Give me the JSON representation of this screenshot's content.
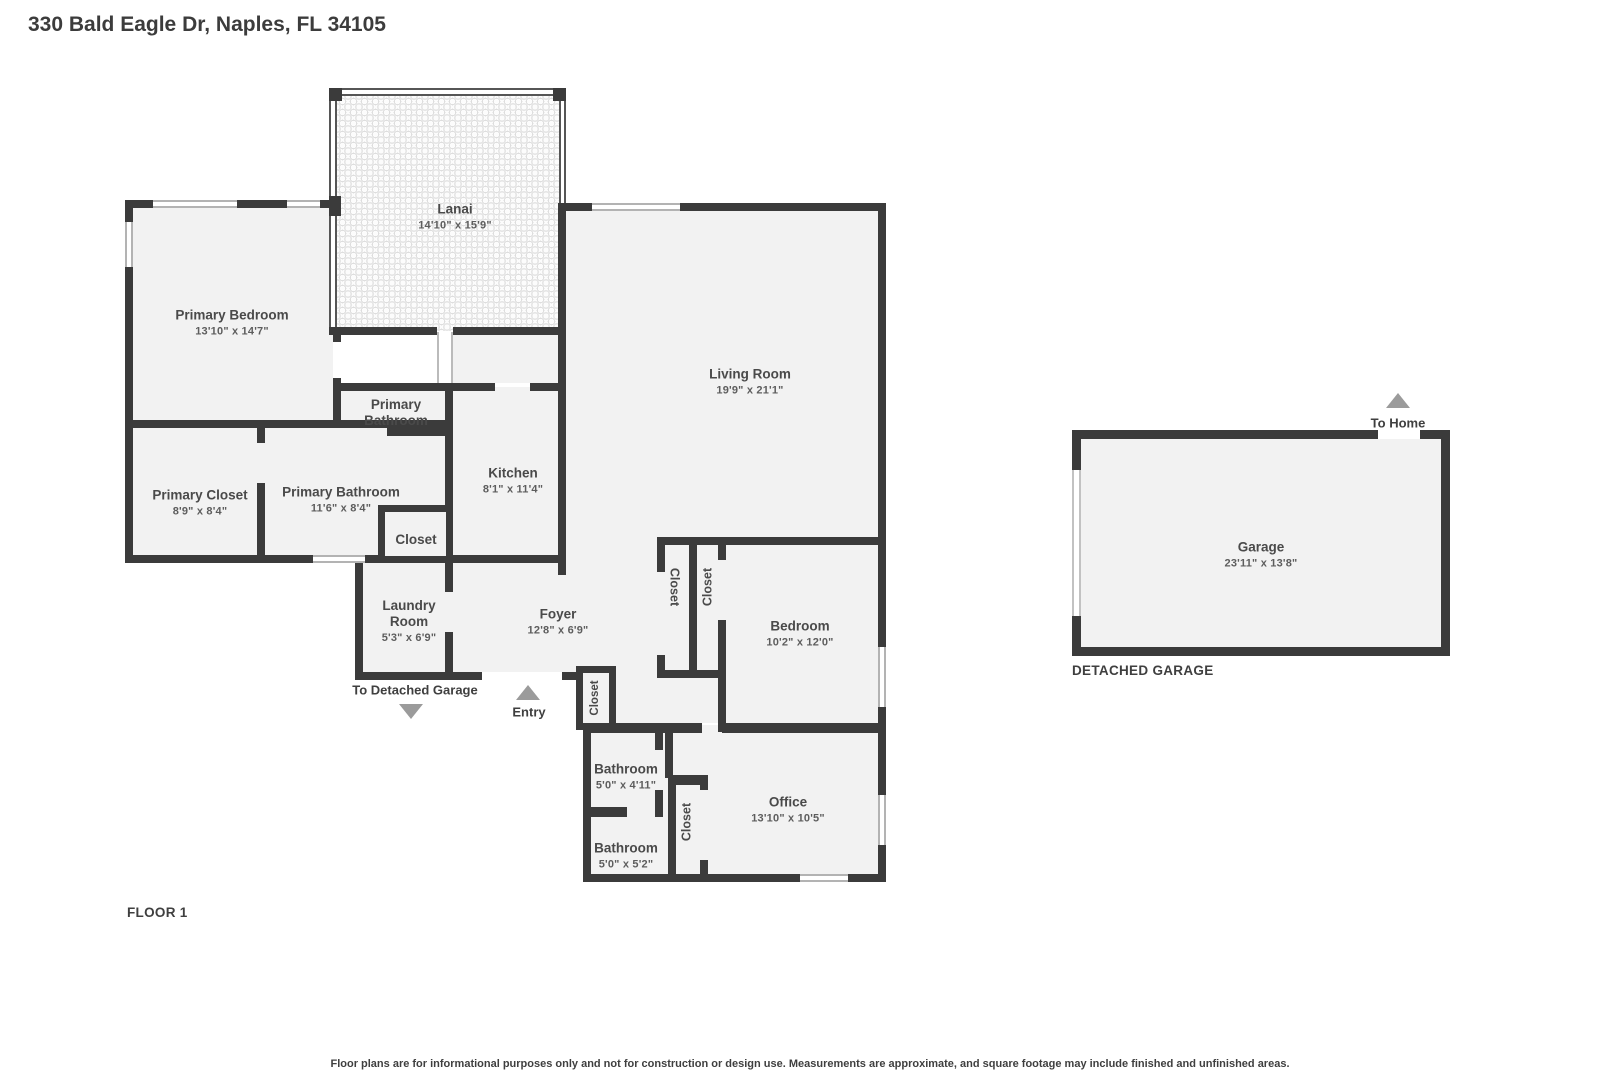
{
  "page_title": "330 Bald Eagle Dr, Naples, FL 34105",
  "floor_plan": {
    "floor_label": "FLOOR 1",
    "detached_garage_label": "DETACHED GARAGE",
    "rooms": {
      "lanai": {
        "name": "Lanai",
        "dims": "14'10\" x 15'9\""
      },
      "primary_bedroom": {
        "name": "Primary Bedroom",
        "dims": "13'10\" x 14'7\""
      },
      "living_room": {
        "name": "Living Room",
        "dims": "19'9\" x 21'1\""
      },
      "primary_bathroom_upper": {
        "name": "Primary Bathroom"
      },
      "kitchen": {
        "name": "Kitchen",
        "dims": "8'1\" x 11'4\""
      },
      "primary_closet": {
        "name": "Primary Closet",
        "dims": "8'9\" x 8'4\""
      },
      "primary_bathroom": {
        "name": "Primary Bathroom",
        "dims": "11'6\" x 8'4\""
      },
      "hall_closet": {
        "name": "Closet"
      },
      "laundry_room": {
        "name": "Laundry Room",
        "dims": "5'3\" x 6'9\""
      },
      "foyer": {
        "name": "Foyer",
        "dims": "12'8\" x 6'9\""
      },
      "closet_1": {
        "name": "Closet"
      },
      "closet_2": {
        "name": "Closet"
      },
      "entry_closet": {
        "name": "Closet"
      },
      "bedroom": {
        "name": "Bedroom",
        "dims": "10'2\" x 12'0\""
      },
      "bathroom_1": {
        "name": "Bathroom",
        "dims": "5'0\" x 4'11\""
      },
      "bathroom_2": {
        "name": "Bathroom",
        "dims": "5'0\" x 5'2\""
      },
      "office_closet": {
        "name": "Closet"
      },
      "office": {
        "name": "Office",
        "dims": "13'10\" x 10'5\""
      },
      "garage": {
        "name": "Garage",
        "dims": "23'11\" x 13'8\""
      }
    },
    "annotations": {
      "to_detached_garage": "To Detached Garage",
      "entry": "Entry",
      "to_home": "To Home"
    }
  },
  "footer": {
    "disclaimer": "Floor plans are for informational purposes only and not for construction or design use. Measurements are approximate, and square footage may include finished and unfinished areas."
  },
  "colors": {
    "wall": "#3b3b3b",
    "room_fill": "#f2f2f2",
    "arrow": "#9b9b9b"
  }
}
